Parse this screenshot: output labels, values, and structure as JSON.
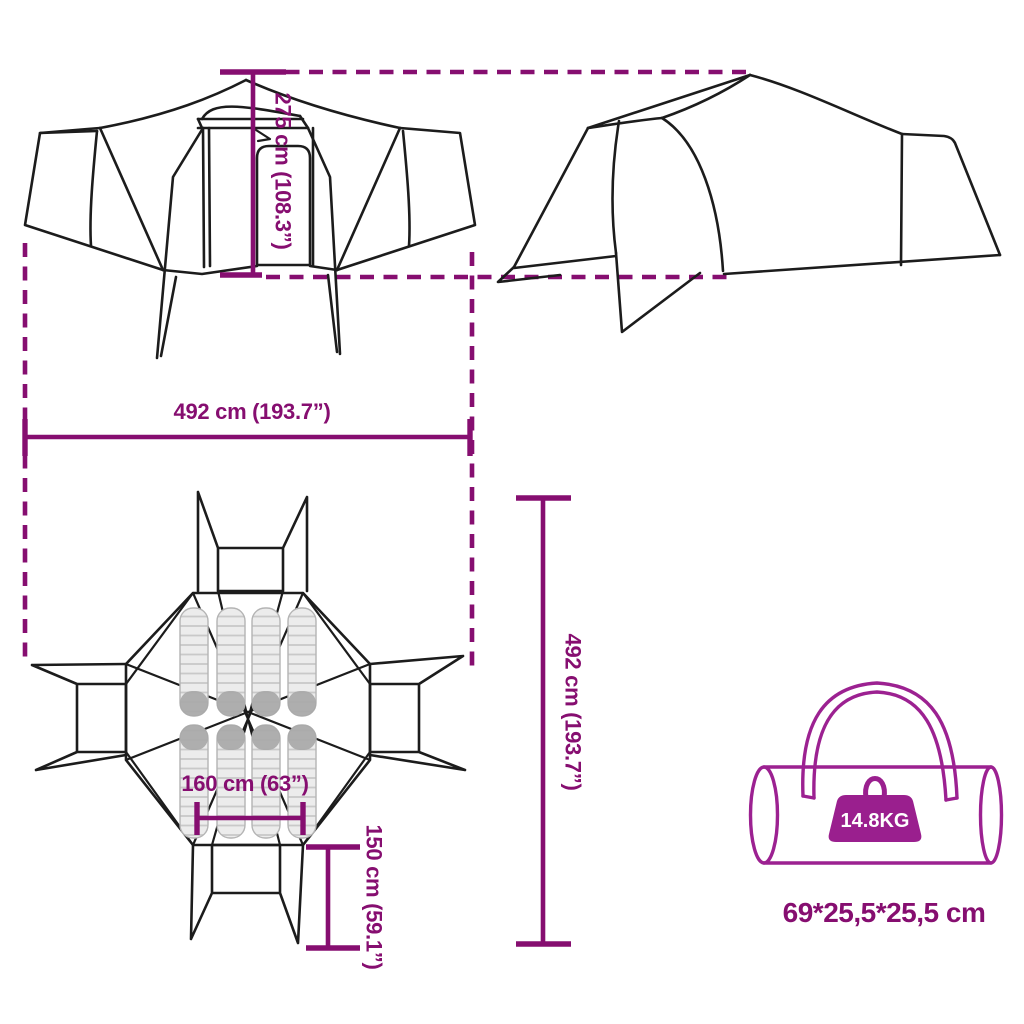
{
  "colors": {
    "dimension": "#860e70",
    "bag": "#9c2191",
    "weight_fill": "#9a1f8e",
    "outline": "#1c1c1c",
    "pad_fill": "#ececec"
  },
  "dimensions": {
    "height": {
      "label": "275 cm (108.3”)"
    },
    "width": {
      "label": "492 cm (193.7”)"
    },
    "depth": {
      "label": "492 cm (193.7”)"
    },
    "inner_width": {
      "label": "160 cm (63”)"
    },
    "vestibule_depth": {
      "label": "150 cm (59.1”)"
    }
  },
  "bag": {
    "weight": "14.8KG",
    "size": "69*25,5*25,5 cm"
  }
}
